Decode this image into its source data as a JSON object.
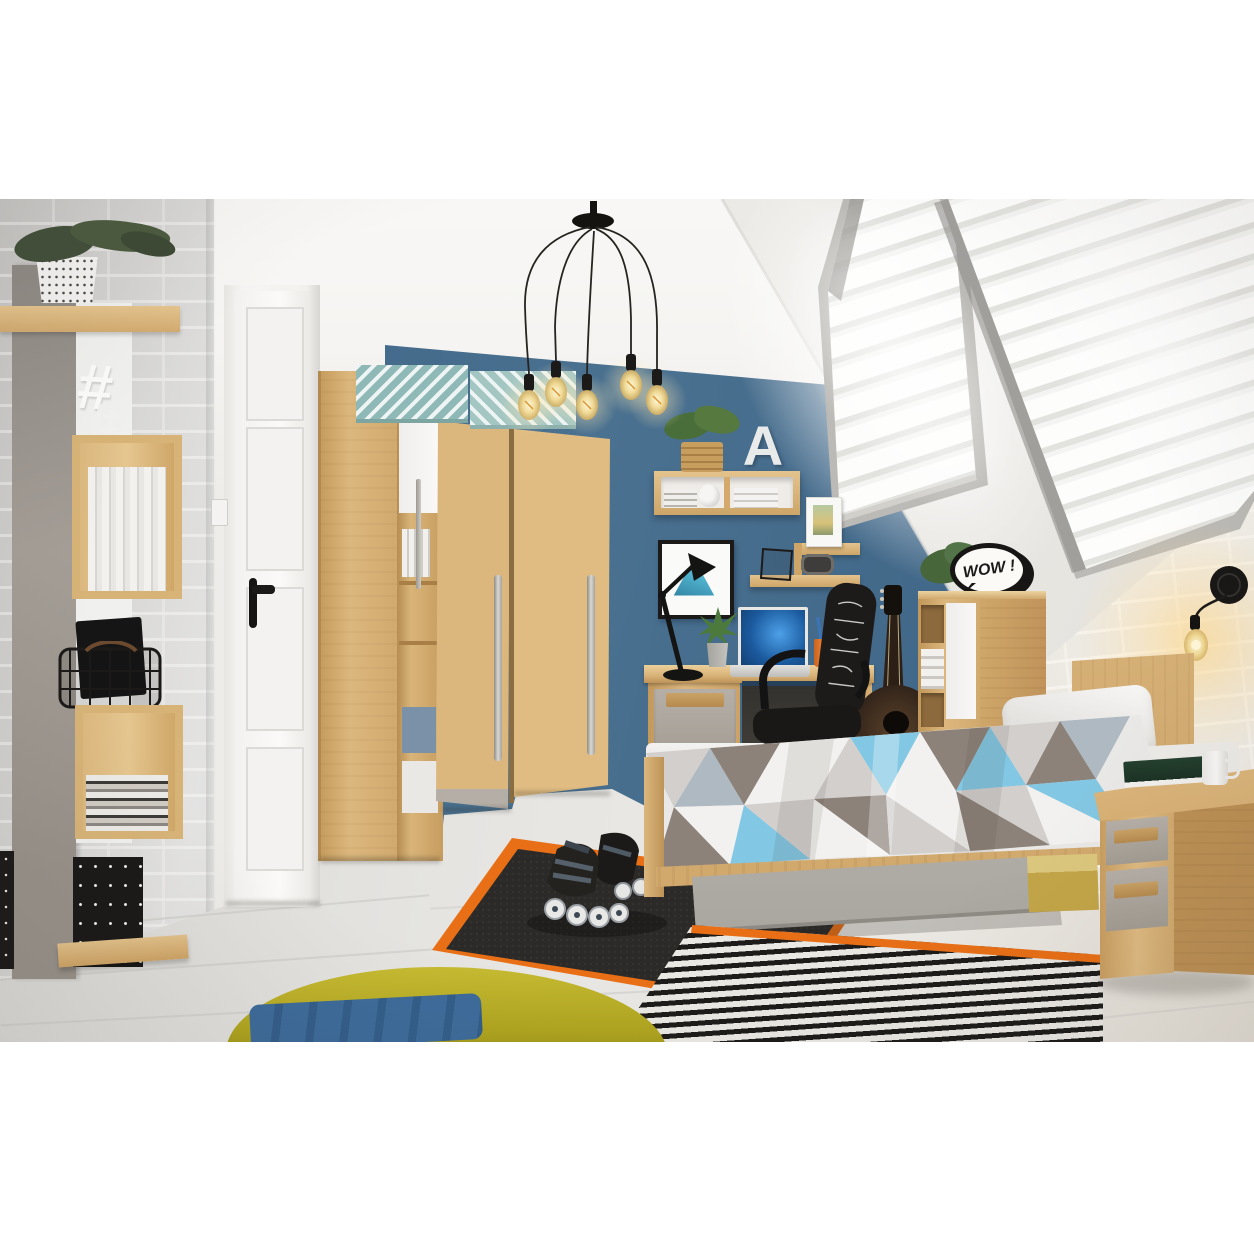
{
  "scene": {
    "type": "interior photograph",
    "subject": "teen attic bedroom furnished with a beech-and-grey furniture set",
    "wow_sign_text": "WOW !",
    "letter_decor": "A",
    "hashtag_decor": "#"
  },
  "palette": {
    "wall_blue": "#45688a",
    "wall_white": "#f2f1ee",
    "brick_grey": "#c7c6c4",
    "brick_white": "#e7e5e1",
    "wood_light": "#dcb77f",
    "wood_mid": "#cda468",
    "front_grey": "#aba49c",
    "floor": "#e0dfdc",
    "rug_dark": "#2d2c2a",
    "rug_orange": "#e86f16",
    "stripe_black": "#1d1c1b",
    "stripe_white": "#eae8e3",
    "pouf_yellow": "#b9ad25",
    "towel_blue": "#3c699b",
    "duvet_blue": "#82c7e3",
    "duvet_taupe": "#8d827a",
    "bulb_warm": "#f7dfa2",
    "chair_black": "#1f1e1d",
    "poster_teal": "#54b0cb"
  }
}
